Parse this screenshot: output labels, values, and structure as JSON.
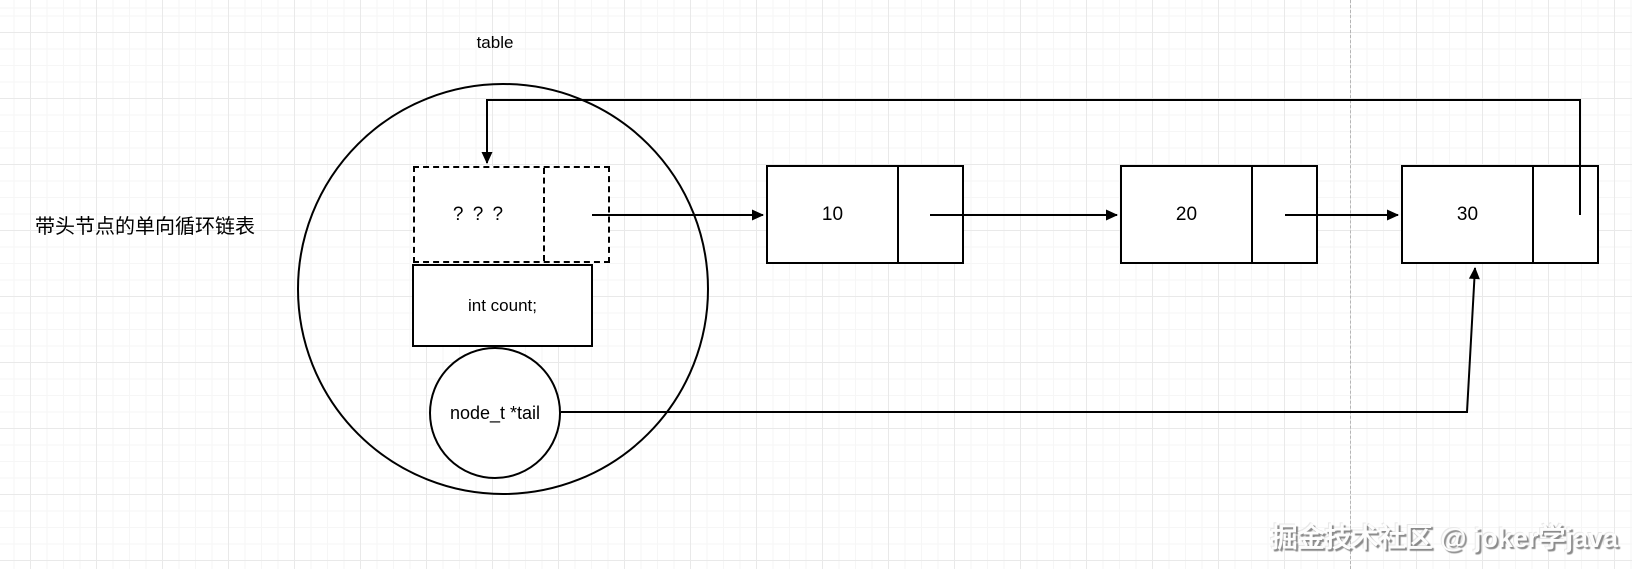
{
  "diagram": {
    "title_label": "带头节点的单向循环链表",
    "table_label": "table",
    "head": {
      "data_label": "? ? ?",
      "count_label": "int count;",
      "tail_label": "node_t *tail"
    },
    "nodes": [
      {
        "value": "10"
      },
      {
        "value": "20"
      },
      {
        "value": "30"
      }
    ],
    "watermark": "掘金技术社区 @ joker学java",
    "colors": {
      "line": "#000000",
      "grid_major": "#e9e9e9",
      "grid_minor": "#f6f6f6",
      "page_boundary": "#b5b5b5",
      "node_fill": "#ffffff"
    }
  }
}
